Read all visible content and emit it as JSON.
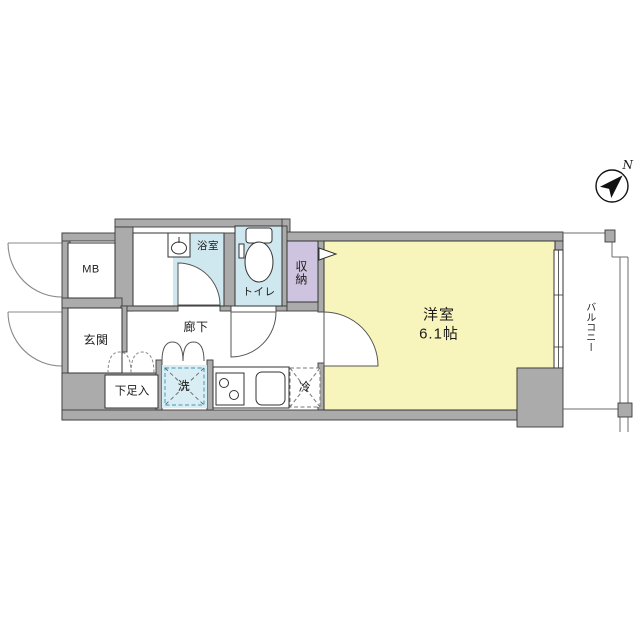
{
  "floorplan": {
    "compass": {
      "north_label": "N"
    },
    "labels": {
      "meter_box": "MB",
      "entrance": "玄関",
      "shoe_storage": "下足入",
      "hallway": "廊下",
      "bathroom": "浴室",
      "toilet": "トイレ",
      "storage": "収納",
      "washer": "洗",
      "fridge": "冷",
      "western_room": "洋室",
      "western_room_size": "6.1帖",
      "balcony": "バルコニー"
    },
    "colors": {
      "wall": "#ababab",
      "wet_area": "#cfe7ef",
      "storage_closet": "#cfc4df",
      "western_room": "#f8f5bc",
      "washer_pad": "#d9edf4"
    }
  }
}
